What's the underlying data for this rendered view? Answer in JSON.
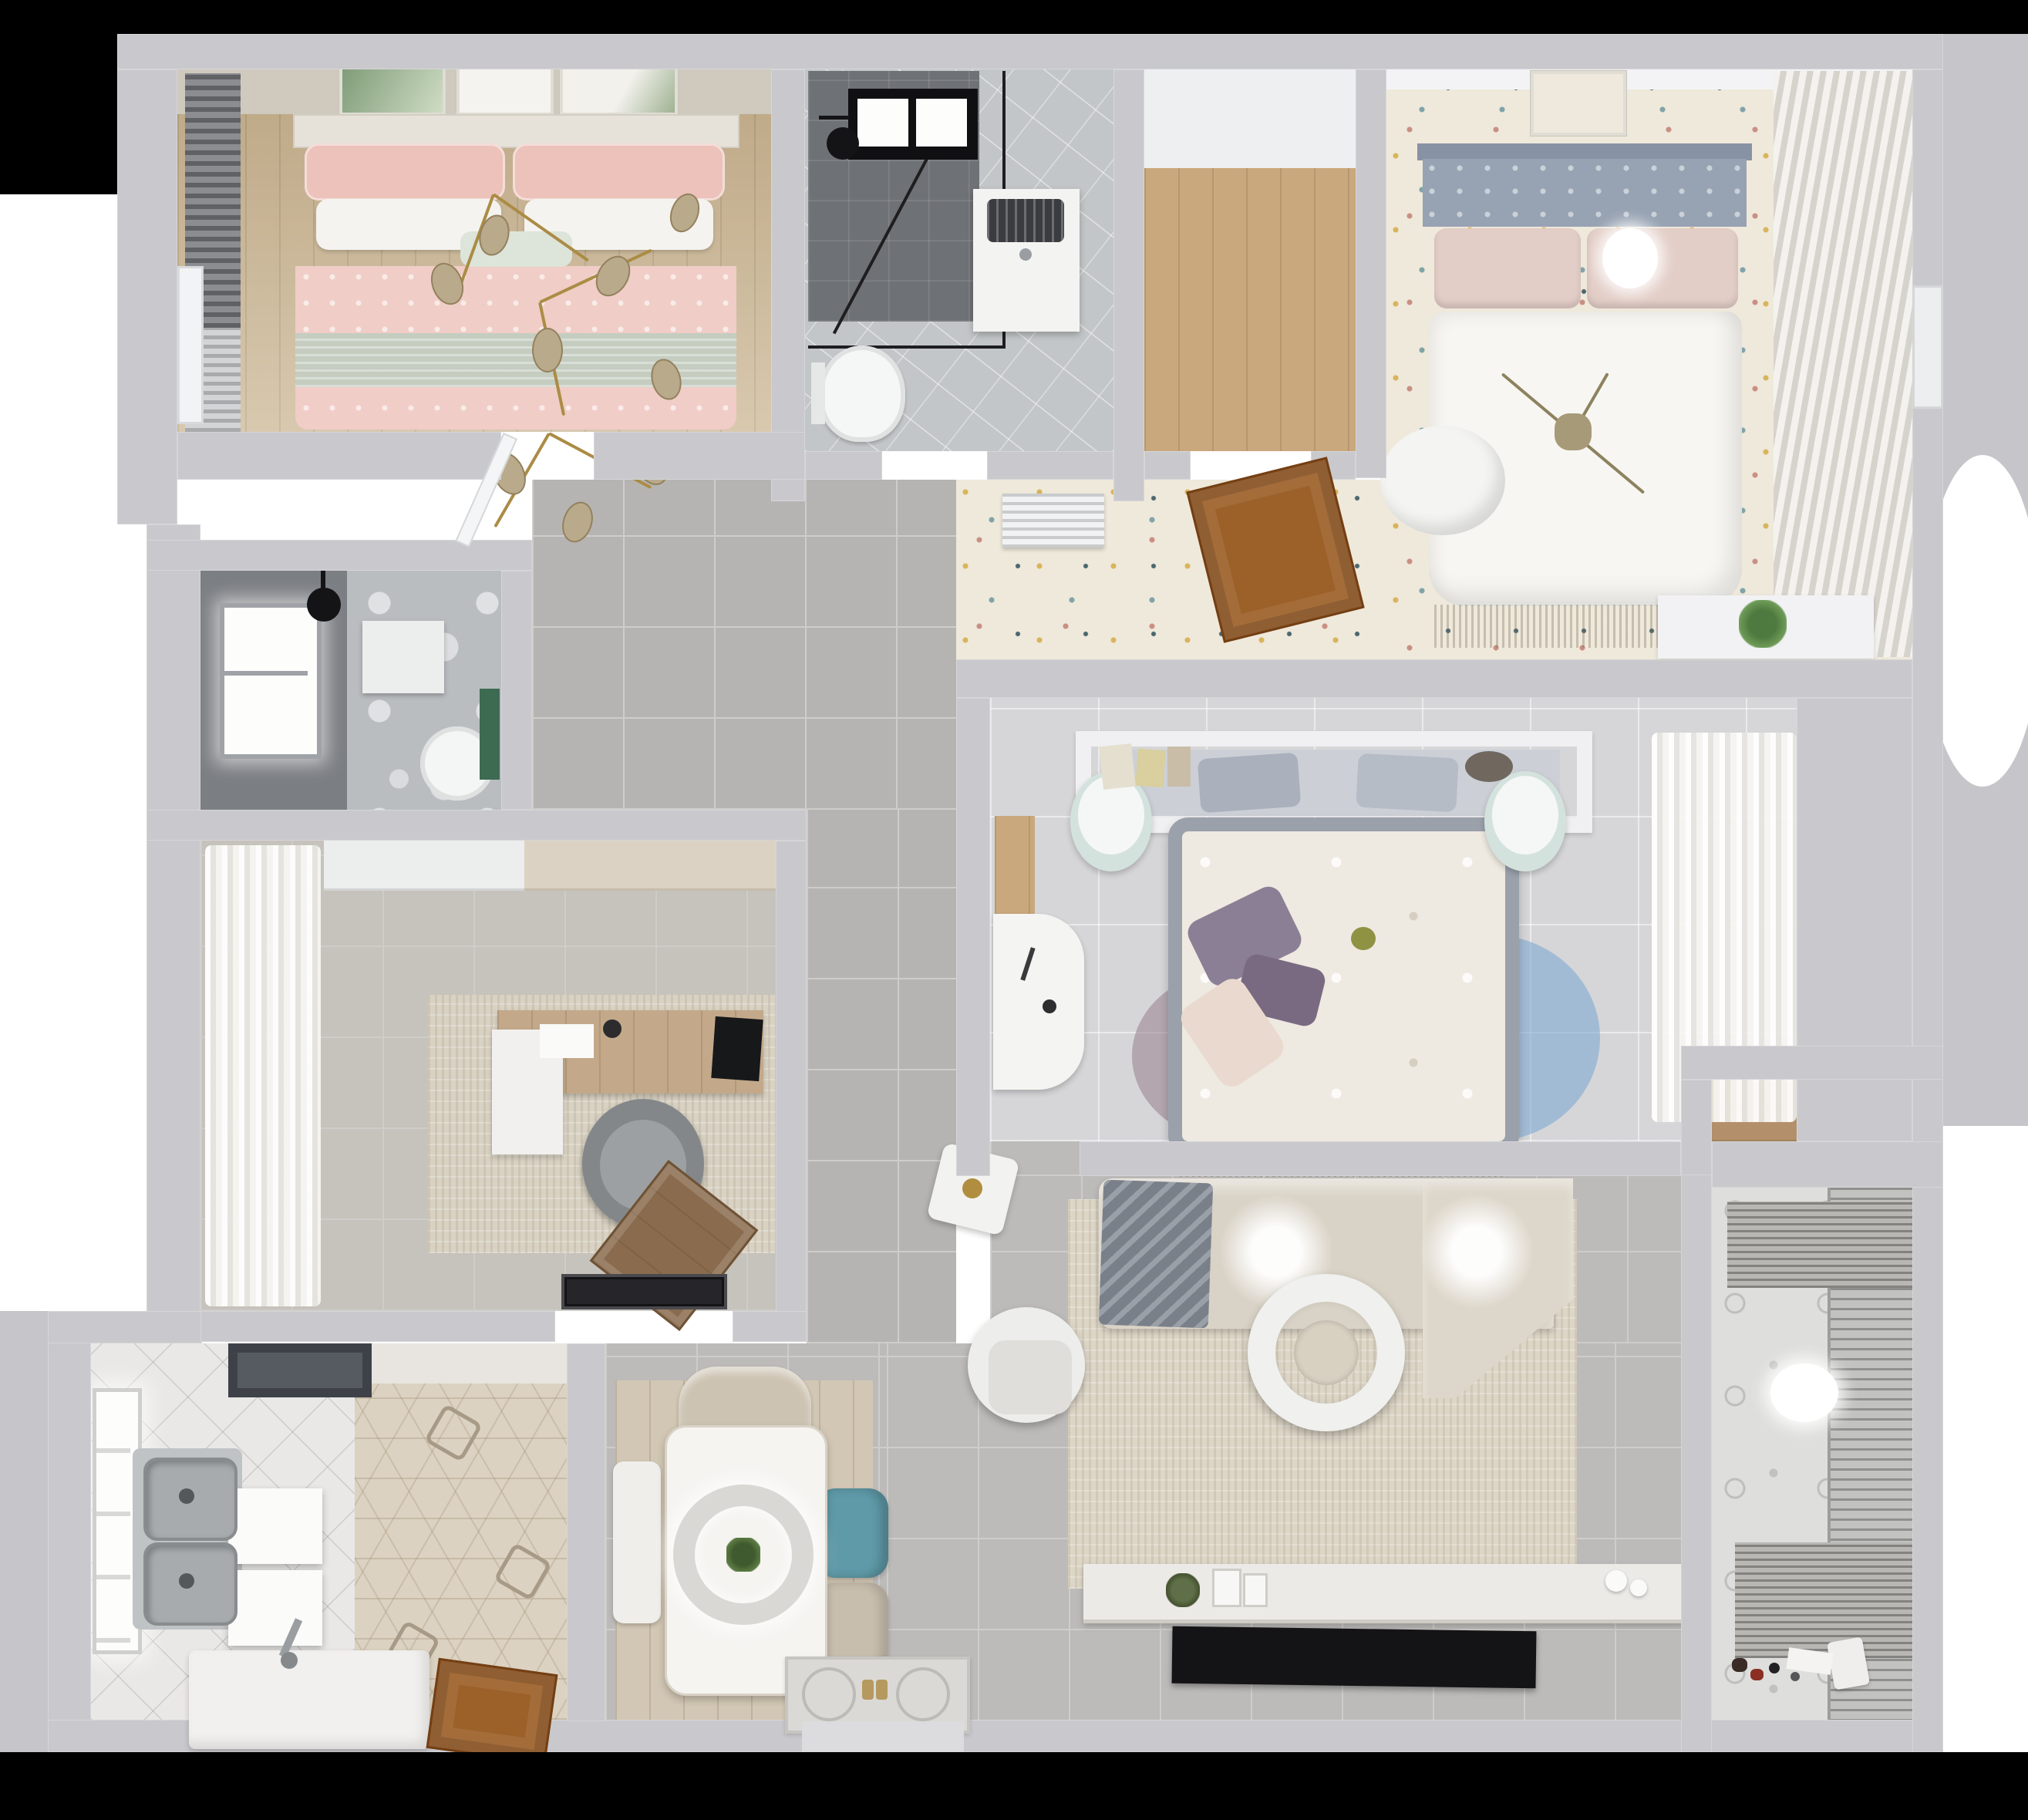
{
  "scene": {
    "type": "3d-floorplan-render",
    "view": "top-down",
    "title": "Apartment 3D floor plan, photorealistic top view render"
  },
  "palette": {
    "wall": "#c9c9cd",
    "ext": "#c6c6ca",
    "corridorTile": "#b6b4b2",
    "livingTile": "#bdbbb9",
    "grout": "#cfcdca",
    "white1": "#e9e8e6",
    "wood1": "#cbb694",
    "wood2": "#c9a87d",
    "woodDoor": "#9c6029",
    "carpet": "#efe9db",
    "dotGold": "#d8b45a",
    "dotTeal": "#7fa3a8",
    "dotNavy": "#4a6670",
    "dotRose": "#c98f83",
    "pink": "#f0cdc6",
    "pinkDeep": "#ecc2ba",
    "sage": "#c5cdc1",
    "mint": "#dde4da",
    "headboard2": "#97a2b2",
    "duvet": "#f7f6f2",
    "bath1Dark": "#6e7175",
    "bath1Tile": "#c3c6c8",
    "bath2Dark": "#7b7e83",
    "marble": "#b9bdc0",
    "green": "#3c6b52",
    "steel": "#a7abae",
    "hood": "#565b62",
    "hex1": "#dcd2c1",
    "studyTile": "#c6c2bc",
    "rugStudy": "#d9d2c3",
    "rugLiving": "#ddd6c7",
    "deskWood": "#c3a98a",
    "chairGray": "#84878a",
    "lounge": "#8a6b4e",
    "teal": "#5f9aa8",
    "beige1": "#cdc3b2",
    "beige2": "#c8beae",
    "sofa": "#d9d2c6",
    "sofaLight": "#ddd6ca",
    "blanket": "#798089",
    "tv": "#141417",
    "gold": "#ab8c45",
    "bulb": "#b9aa8b",
    "rugBlue": "#7fa9d4",
    "rugMauve": "#997f8d",
    "rugSage": "#9aa396",
    "purple1": "#8b7f95",
    "purple2": "#796a81",
    "blush": "#ead9ce",
    "matBlack": "#26262a",
    "balconyTile": "#e0e0de"
  },
  "rooms": [
    {
      "id": "bedroom-pink",
      "label": "Bedroom with pink bedding (top left)",
      "items": [
        "double bed",
        "pink patterned pillows",
        "white pillows",
        "mint cushion",
        "sage green throw band",
        "gold branch chandelier with glass leaves",
        "three botanical wall artworks",
        "dark slatted window curtains",
        "wood plank floor"
      ]
    },
    {
      "id": "bathroom-main",
      "label": "Main bathroom (top center)",
      "items": [
        "black framed glass shower",
        "black shower head",
        "skylight window",
        "washing machine",
        "wall hung toilet",
        "diagonal gray tile floor"
      ]
    },
    {
      "id": "closet-hall",
      "label": "Closet / hall room with wood floor",
      "items": [
        "light wood plank floor",
        "white walls"
      ]
    },
    {
      "id": "bedroom-master",
      "label": "Master bedroom (top right)",
      "items": [
        "double bed with white duvet",
        "blue-gray tufted headboard",
        "blush pillows",
        "round ceiling light over pillow",
        "framed artwork above headboard",
        "white bean bag at bed foot",
        "sheer slatted curtains on right wall",
        "confetti speckled carpet",
        "white shelf with green plant"
      ]
    },
    {
      "id": "hallway",
      "label": "Hallway with speckled carpet",
      "items": [
        "open wooden door",
        "white slatted air vent"
      ]
    },
    {
      "id": "bathroom-ensuite",
      "label": "Second bathroom (middle left)",
      "items": [
        "dark gray wall tiles",
        "bright window",
        "black rain shower head",
        "white vanity cabinet",
        "toilet",
        "green accent strip",
        "white marble floor"
      ]
    },
    {
      "id": "study",
      "label": "Study / home office",
      "items": [
        "wooden desk",
        "black monitor",
        "white desk return",
        "gray round swivel chair",
        "brown wood lounge chair",
        "beige area rug",
        "billowy sheer curtains",
        "white and beige wall cabinets",
        "black door mat"
      ]
    },
    {
      "id": "bedroom-center",
      "label": "Center bedroom",
      "items": [
        "gray upholstered bed with floral duvet",
        "purple pillows",
        "blush pillow",
        "headboard shelf with books and bowl",
        "two mint ottomans",
        "white corner desk",
        "layered round rug in blue, mauve and sage",
        "sheer wardrobe curtains",
        "wood floor strip at window"
      ]
    },
    {
      "id": "corridor",
      "label": "Corridor with large gray floor tiles",
      "items": []
    },
    {
      "id": "kitchen",
      "label": "Kitchen (bottom left)",
      "items": [
        "double stainless steel sink",
        "tall faucet",
        "dark range hood",
        "two bright white cabinet fronts",
        "white counter slab",
        "hexagonal patterned tile floor",
        "white diagonal tile floor",
        "bright window",
        "wooden door"
      ]
    },
    {
      "id": "dining",
      "label": "Dining area",
      "items": [
        "white rectangular dining table",
        "ring pendant lamp with plant centerpiece",
        "beige chair at head",
        "teal side chair",
        "beige side chair",
        "white bench",
        "light wood floor mat"
      ]
    },
    {
      "id": "living",
      "label": "Living room",
      "items": [
        "corner sofa with angled chaise",
        "gray striped blanket",
        "two ceiling light glows",
        "large beige rug",
        "round white nesting coffee table",
        "white round-back armchair",
        "rotated white side table with gold decor",
        "long white TV sideboard with green plate and frames",
        "flat black TV panel",
        "ornate entry doormat with gold handles"
      ]
    },
    {
      "id": "balcony",
      "label": "Balcony / laundry room (bottom right)",
      "items": [
        "slatted window blinds",
        "two drying racks",
        "round white ceiling light",
        "small toys on the floor",
        "patterned light tile wall"
      ]
    },
    {
      "id": "closet-balcony",
      "label": "Closet niche above balcony",
      "items": [
        "wood shelf interior"
      ]
    }
  ]
}
